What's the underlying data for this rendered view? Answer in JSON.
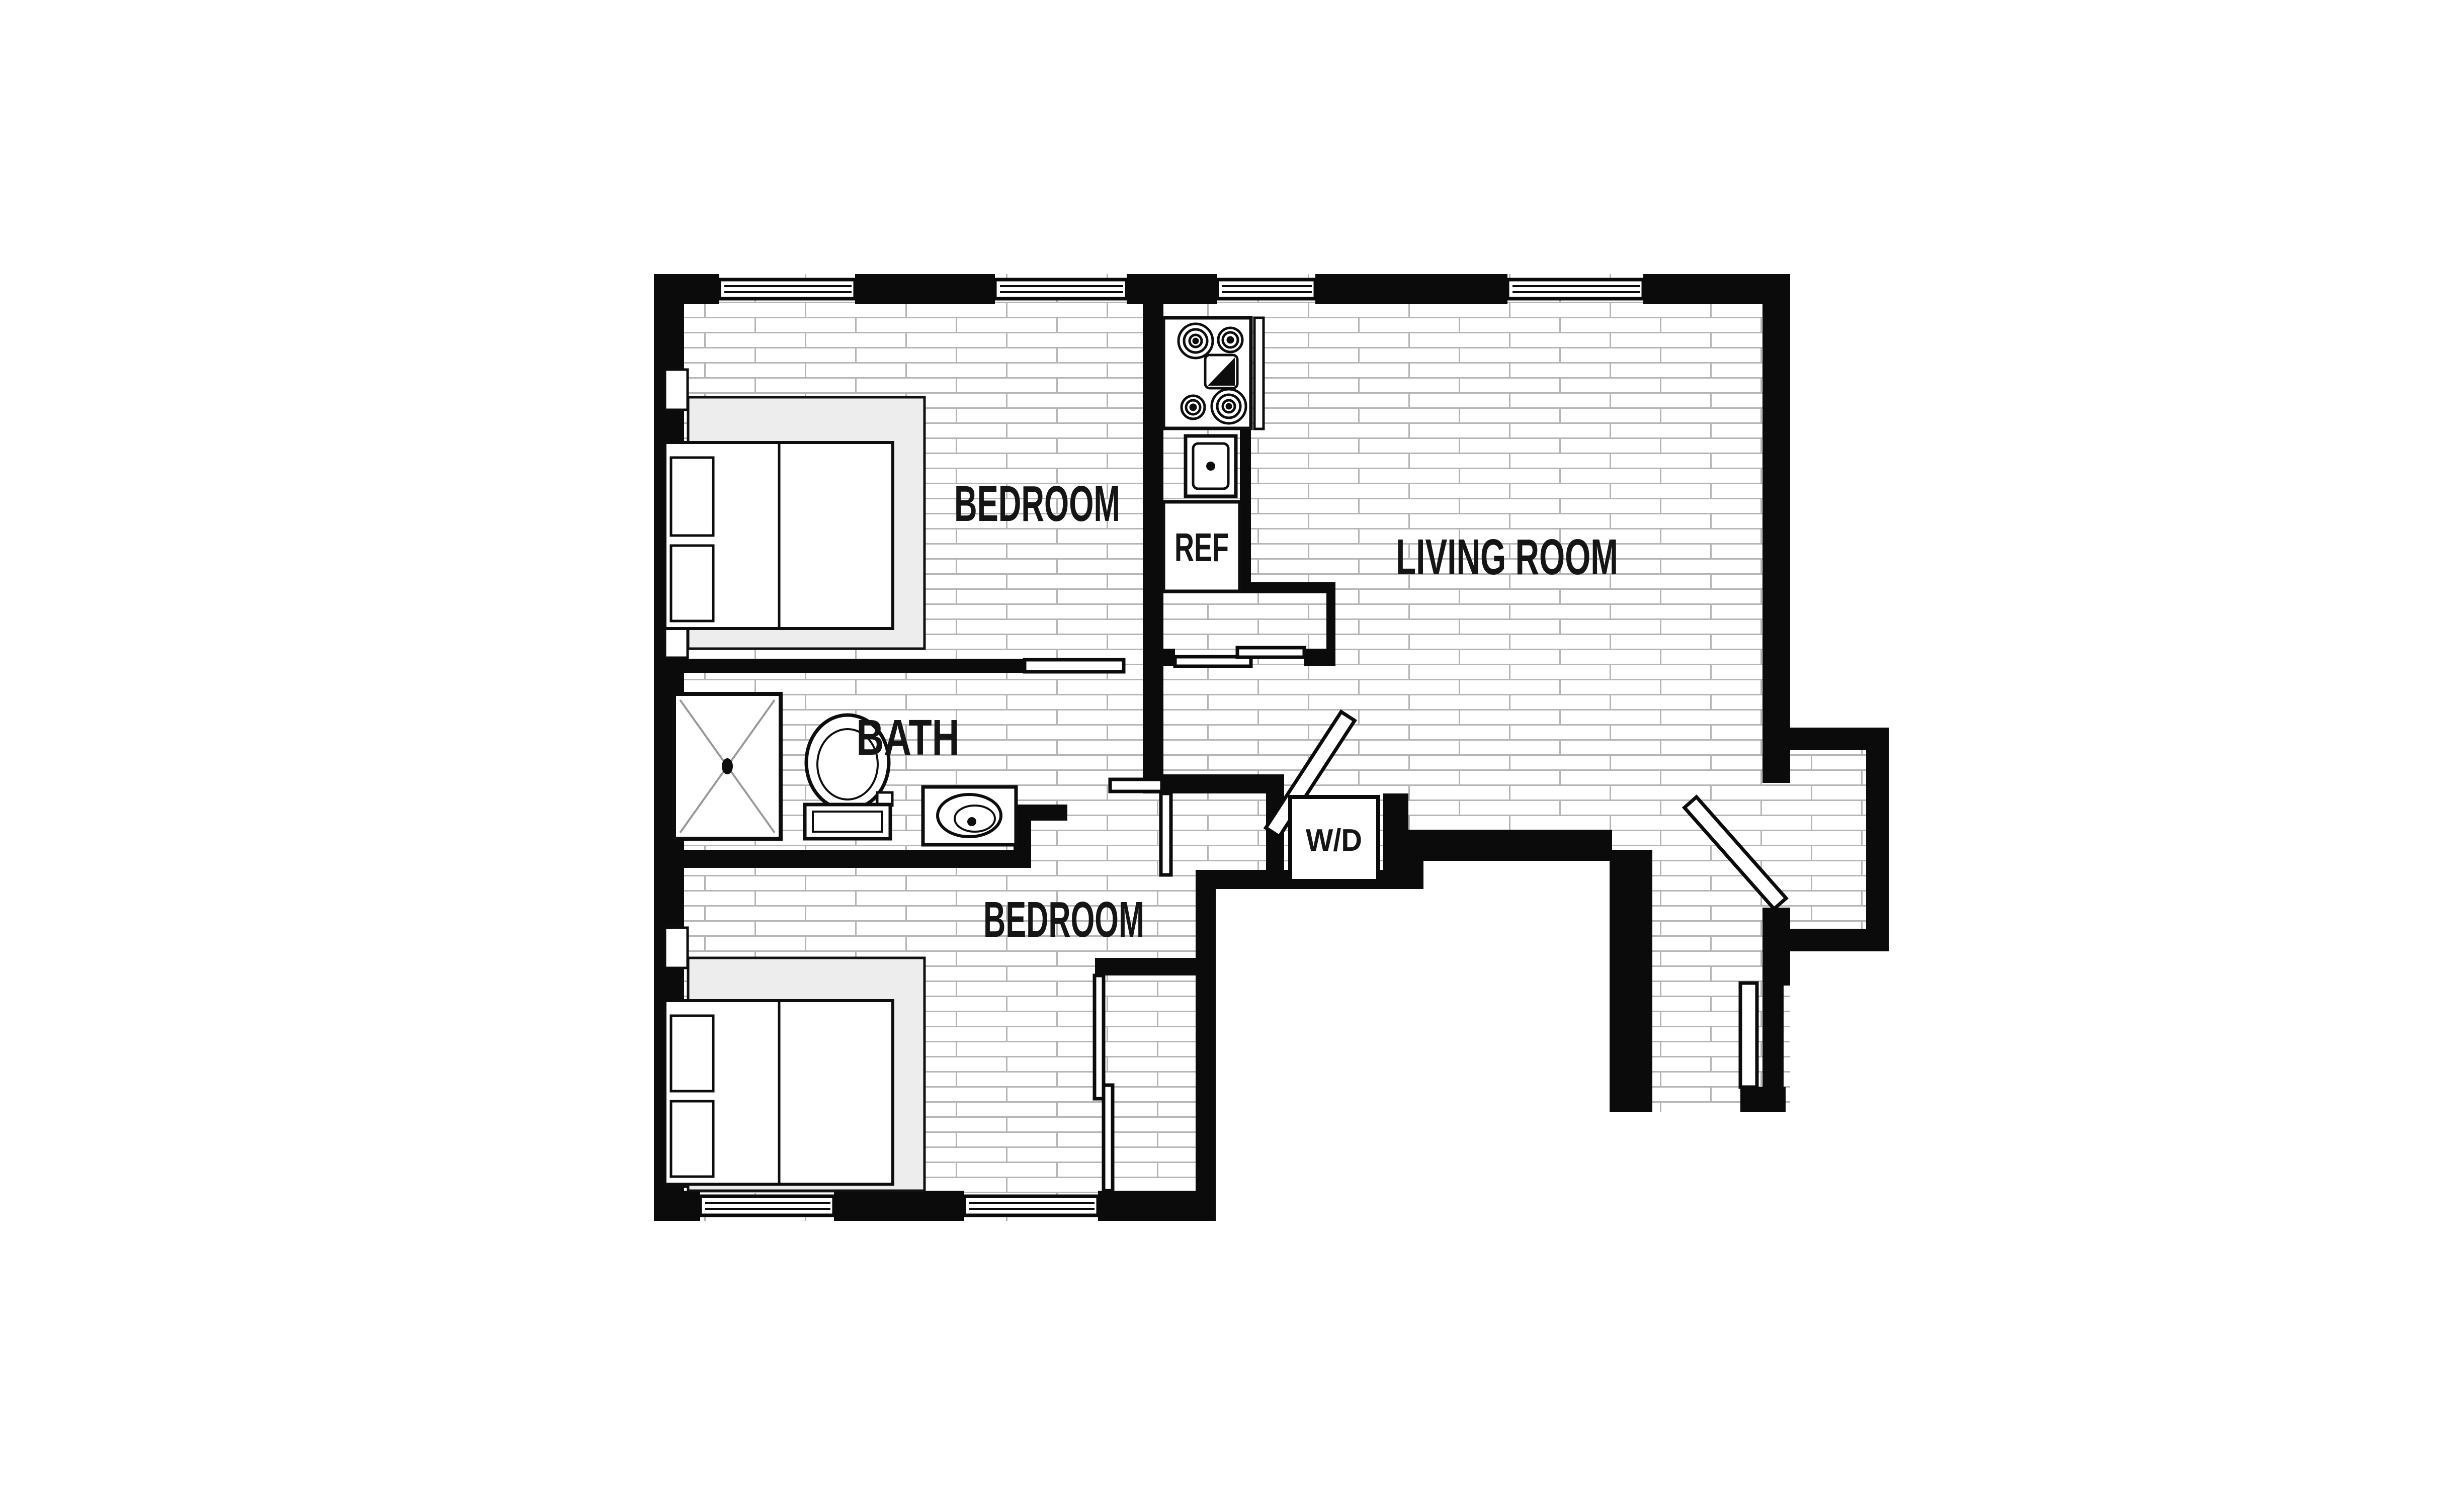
{
  "title": "Two Bedroom Apartment Floor Plan",
  "colors": {
    "wall": "#0b0b0b",
    "floor_joint_line": "#b5b5b5",
    "bed_platform": "#ededed",
    "fixture_stroke": "#0d0d0d",
    "label_text": "#151515",
    "background": "#ffffff"
  },
  "rooms": {
    "bedroom_top": {
      "label": "BEDROOM"
    },
    "living_room": {
      "label": "LIVING ROOM"
    },
    "bath": {
      "label": "BATH"
    },
    "bedroom_bottom": {
      "label": "BEDROOM"
    },
    "laundry_closet": {
      "label": "W/D"
    },
    "kitchen": {
      "refrigerator_label": "REF"
    }
  },
  "icons": {
    "stove": "four-burner-cooktop-icon",
    "cutting_board": "cutting-board-icon",
    "kitchen_sink": "kitchen-sink-icon",
    "refrigerator": "refrigerator-box",
    "shower": "shower-stall-icon",
    "toilet": "toilet-icon",
    "vanity_sink": "vanity-sink-icon",
    "bed": "double-bed-icon",
    "window": "triple-line-window-symbol",
    "door": "door-leaf-symbol"
  }
}
